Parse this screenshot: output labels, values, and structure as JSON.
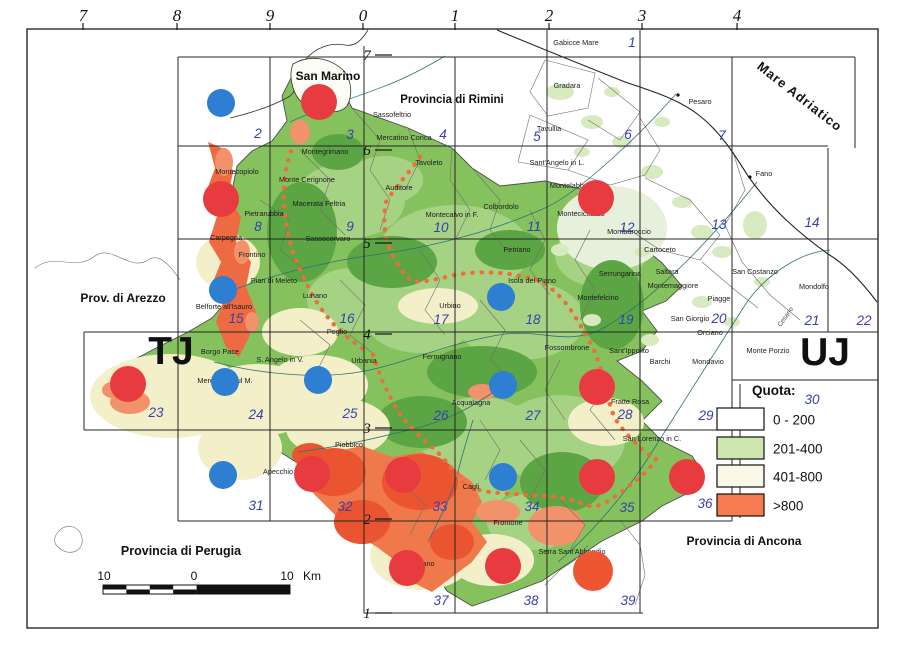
{
  "map": {
    "easting_labels": [
      {
        "t": "7",
        "x": 83
      },
      {
        "t": "8",
        "x": 177
      },
      {
        "t": "9",
        "x": 270
      },
      {
        "t": "0",
        "x": 363
      },
      {
        "t": "1",
        "x": 455
      },
      {
        "t": "2",
        "x": 549
      },
      {
        "t": "3",
        "x": 642
      },
      {
        "t": "4",
        "x": 737
      }
    ],
    "northing_labels": [
      {
        "t": "7",
        "y": 55
      },
      {
        "t": "6",
        "y": 150
      },
      {
        "t": "5",
        "y": 243
      },
      {
        "t": "4",
        "y": 334
      },
      {
        "t": "3",
        "y": 428
      },
      {
        "t": "2",
        "y": 519
      },
      {
        "t": "1",
        "y": 613
      }
    ],
    "zone_labels": [
      {
        "t": "TJ",
        "x": 171,
        "y": 364
      },
      {
        "t": "UJ",
        "x": 825,
        "y": 365
      }
    ],
    "sheet_numbers": [
      {
        "n": "1",
        "x": 632,
        "y": 47
      },
      {
        "n": "2",
        "x": 258,
        "y": 138
      },
      {
        "n": "3",
        "x": 350,
        "y": 139
      },
      {
        "n": "4",
        "x": 443,
        "y": 139
      },
      {
        "n": "5",
        "x": 537,
        "y": 141
      },
      {
        "n": "6",
        "x": 628,
        "y": 139
      },
      {
        "n": "7",
        "x": 722,
        "y": 140
      },
      {
        "n": "8",
        "x": 258,
        "y": 231
      },
      {
        "n": "9",
        "x": 350,
        "y": 231
      },
      {
        "n": "10",
        "x": 441,
        "y": 232
      },
      {
        "n": "11",
        "x": 534,
        "y": 231
      },
      {
        "n": "12",
        "x": 627,
        "y": 232
      },
      {
        "n": "13",
        "x": 719,
        "y": 229
      },
      {
        "n": "14",
        "x": 812,
        "y": 227
      },
      {
        "n": "15",
        "x": 236,
        "y": 323
      },
      {
        "n": "16",
        "x": 347,
        "y": 323
      },
      {
        "n": "17",
        "x": 441,
        "y": 324
      },
      {
        "n": "18",
        "x": 533,
        "y": 324
      },
      {
        "n": "19",
        "x": 626,
        "y": 324
      },
      {
        "n": "20",
        "x": 719,
        "y": 323
      },
      {
        "n": "21",
        "x": 812,
        "y": 325
      },
      {
        "n": "22",
        "x": 864,
        "y": 325
      },
      {
        "n": "23",
        "x": 156,
        "y": 417
      },
      {
        "n": "24",
        "x": 256,
        "y": 419
      },
      {
        "n": "25",
        "x": 350,
        "y": 418
      },
      {
        "n": "26",
        "x": 441,
        "y": 420
      },
      {
        "n": "27",
        "x": 533,
        "y": 420
      },
      {
        "n": "28",
        "x": 625,
        "y": 419
      },
      {
        "n": "29",
        "x": 706,
        "y": 420
      },
      {
        "n": "30",
        "x": 812,
        "y": 404
      },
      {
        "n": "31",
        "x": 256,
        "y": 510
      },
      {
        "n": "32",
        "x": 345,
        "y": 511
      },
      {
        "n": "33",
        "x": 440,
        "y": 511
      },
      {
        "n": "34",
        "x": 532,
        "y": 511
      },
      {
        "n": "35",
        "x": 627,
        "y": 512
      },
      {
        "n": "36",
        "x": 705,
        "y": 508
      },
      {
        "n": "37",
        "x": 441,
        "y": 605
      },
      {
        "n": "38",
        "x": 531,
        "y": 605
      },
      {
        "n": "39",
        "x": 628,
        "y": 605
      }
    ],
    "sea_label": {
      "text": "Mare Adriatico",
      "x": 797,
      "y": 100,
      "angle": 38,
      "size": 13
    },
    "region_labels": [
      {
        "text": "San Marino",
        "x": 328,
        "y": 80,
        "size": 12
      },
      {
        "text": "Provincia di Rimini",
        "x": 452,
        "y": 103,
        "size": 11.5
      },
      {
        "text": "Prov. di Arezzo",
        "x": 123,
        "y": 302,
        "size": 12
      },
      {
        "text": "Provincia di Perugia",
        "x": 181,
        "y": 555,
        "size": 12.5
      },
      {
        "text": "Provincia di Ancona",
        "x": 744,
        "y": 545,
        "size": 12
      }
    ],
    "place_labels": [
      {
        "text": "Gabicce Mare",
        "x": 576,
        "y": 45
      },
      {
        "text": "Gradara",
        "x": 567,
        "y": 88
      },
      {
        "text": "Pesaro",
        "x": 700,
        "y": 104
      },
      {
        "text": "Tavullia",
        "x": 549,
        "y": 131
      },
      {
        "text": "Fano",
        "x": 764,
        "y": 176
      },
      {
        "text": "Sassofeltrio",
        "x": 392,
        "y": 117
      },
      {
        "text": "Mercatino Conca",
        "x": 404,
        "y": 140
      },
      {
        "text": "Montegrimano",
        "x": 325,
        "y": 154
      },
      {
        "text": "Monte Cerignone",
        "x": 307,
        "y": 182
      },
      {
        "text": "Montecopiolo",
        "x": 237,
        "y": 174
      },
      {
        "text": "Pietrarubbia",
        "x": 264,
        "y": 216
      },
      {
        "text": "Macerata Feltria",
        "x": 319,
        "y": 206
      },
      {
        "text": "Carpegna",
        "x": 226,
        "y": 240
      },
      {
        "text": "Frontino",
        "x": 252,
        "y": 257
      },
      {
        "text": "Sassocorvaro",
        "x": 328,
        "y": 241
      },
      {
        "text": "Pian di Meleto",
        "x": 274,
        "y": 283
      },
      {
        "text": "Lunano",
        "x": 315,
        "y": 298
      },
      {
        "text": "Belforte all'Isauro",
        "x": 224,
        "y": 309
      },
      {
        "text": "Auditore",
        "x": 399,
        "y": 190
      },
      {
        "text": "Tavoleto",
        "x": 429,
        "y": 165
      },
      {
        "text": "Montecalvo in F.",
        "x": 452,
        "y": 217
      },
      {
        "text": "Colbordolo",
        "x": 501,
        "y": 209
      },
      {
        "text": "Sant'Angelo in L.",
        "x": 557,
        "y": 165
      },
      {
        "text": "Montelabbate",
        "x": 572,
        "y": 188
      },
      {
        "text": "Monteciccardo",
        "x": 581,
        "y": 216
      },
      {
        "text": "Mombaroccio",
        "x": 629,
        "y": 234
      },
      {
        "text": "Petriano",
        "x": 517,
        "y": 252
      },
      {
        "text": "Isola del Piano",
        "x": 532,
        "y": 283
      },
      {
        "text": "Urbino",
        "x": 450,
        "y": 308
      },
      {
        "text": "Cartoceto",
        "x": 660,
        "y": 252
      },
      {
        "text": "Saltara",
        "x": 667,
        "y": 274
      },
      {
        "text": "Montemaggiore",
        "x": 673,
        "y": 288
      },
      {
        "text": "San Costanzo",
        "x": 755,
        "y": 274
      },
      {
        "text": "Mondolfo",
        "x": 814,
        "y": 289
      },
      {
        "text": "Piagge",
        "x": 719,
        "y": 301
      },
      {
        "text": "San Giorgio",
        "x": 690,
        "y": 321
      },
      {
        "text": "Orciano",
        "x": 710,
        "y": 335
      },
      {
        "text": "Serrungarina",
        "x": 620,
        "y": 276
      },
      {
        "text": "Montefelcino",
        "x": 598,
        "y": 300
      },
      {
        "text": "Monte Porzio",
        "x": 768,
        "y": 353
      },
      {
        "text": "Mondavio",
        "x": 708,
        "y": 364
      },
      {
        "text": "Barchi",
        "x": 660,
        "y": 364
      },
      {
        "text": "Sant'Ippolito",
        "x": 629,
        "y": 353
      },
      {
        "text": "Fossombrone",
        "x": 567,
        "y": 350
      },
      {
        "text": "Fermignano",
        "x": 442,
        "y": 359
      },
      {
        "text": "Urbania",
        "x": 364,
        "y": 363
      },
      {
        "text": "Peglio",
        "x": 337,
        "y": 334
      },
      {
        "text": "Borgo Pace",
        "x": 220,
        "y": 354
      },
      {
        "text": "S. Angelo in V.",
        "x": 280,
        "y": 362
      },
      {
        "text": "Mercatello sul M.",
        "x": 225,
        "y": 383
      },
      {
        "text": "Acqualagna",
        "x": 471,
        "y": 405
      },
      {
        "text": "Piobbico",
        "x": 349,
        "y": 447
      },
      {
        "text": "Apecchio",
        "x": 278,
        "y": 474
      },
      {
        "text": "Cagli",
        "x": 471,
        "y": 489
      },
      {
        "text": "Fratte Rosa",
        "x": 630,
        "y": 404
      },
      {
        "text": "San Lorenzo in C.",
        "x": 652,
        "y": 441
      },
      {
        "text": "Frontone",
        "x": 508,
        "y": 525
      },
      {
        "text": "Serra Sant'Abbondio",
        "x": 572,
        "y": 554
      },
      {
        "text": "Cantiano",
        "x": 420,
        "y": 566
      }
    ],
    "river_label": {
      "text": "Cesano",
      "x": 787,
      "y": 318,
      "angle": -55
    },
    "markers": {
      "red_color": "#e83b40",
      "blue_color": "#2e7ed2",
      "orange_red_color": "#ee5533",
      "red_radius": 18,
      "blue_radius": 14,
      "red": [
        [
          319,
          102
        ],
        [
          221,
          199
        ],
        [
          596,
          198
        ],
        [
          128,
          384
        ],
        [
          597,
          387
        ],
        [
          312,
          474
        ],
        [
          403,
          475
        ],
        [
          597,
          477
        ],
        [
          687,
          477
        ],
        [
          407,
          568
        ],
        [
          503,
          566
        ]
      ],
      "orange_red": [
        [
          593,
          571
        ]
      ],
      "blue": [
        [
          221,
          103
        ],
        [
          223,
          290
        ],
        [
          501,
          297
        ],
        [
          225,
          382
        ],
        [
          318,
          380
        ],
        [
          503,
          385
        ],
        [
          223,
          475
        ],
        [
          503,
          477
        ]
      ]
    },
    "legend": {
      "title": "Quota:",
      "items": [
        {
          "label": "0 - 200",
          "color": "#ffffff"
        },
        {
          "label": "201-400",
          "color": "#cfe6ae"
        },
        {
          "label": "401-800",
          "color": "#f9f8e6"
        },
        {
          "label": ">800",
          "color": "#f57b50"
        }
      ]
    },
    "scalebar": {
      "left_label": "10",
      "mid_label": "0",
      "right_label": "10",
      "unit": "Km"
    },
    "palette": {
      "frame": "#1b1b1b",
      "grid": "#262626",
      "sheet_number": "#3641ae",
      "graticule_text": "#111111",
      "base_green": "#85c25e",
      "light_green": "#a6d284",
      "dark_green": "#5ca544",
      "pale_green": "#d8eabf",
      "pale_mix": "#e7f0da",
      "cream": "#f3efc8",
      "orange": "#f2926a",
      "orange_deep": "#f0794c",
      "red_terrain": "#eb5430",
      "west_band": "#ee6a42",
      "boundary": "#6f6f6f",
      "river": "#2f7276",
      "coast": "#222222",
      "dots": "#ef6d38",
      "label_text": "#1c1c1c"
    }
  }
}
